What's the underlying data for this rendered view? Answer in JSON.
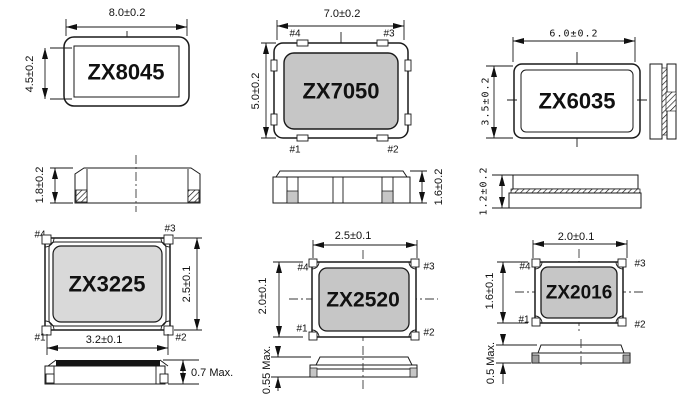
{
  "colors": {
    "line": "#1a1a1a",
    "body_gray": "#c6c6c6",
    "body_light_gray": "#d9d9d9",
    "lid_black": "#141414",
    "pad_gray": "#9e9e9e"
  },
  "packages": [
    {
      "name": "ZX8045",
      "length": "8.0±0.2",
      "width": "4.5±0.2",
      "height": "1.8±0.2"
    },
    {
      "name": "ZX7050",
      "length": "7.0±0.2",
      "width": "5.0±0.2",
      "height": "1.6±0.2",
      "pads": {
        "p1": "#1",
        "p2": "#2",
        "p3": "#3",
        "p4": "#4"
      }
    },
    {
      "name": "ZX6035",
      "length": "6.0±0.2",
      "width": "3.5±0.2",
      "height": "1.2±0.2"
    },
    {
      "name": "ZX3225",
      "length": "3.2±0.1",
      "width": "2.5±0.1",
      "height": "0.7 Max.",
      "pads": {
        "p1": "#1",
        "p2": "#2",
        "p3": "#3",
        "p4": "#4"
      }
    },
    {
      "name": "ZX2520",
      "length": "2.5±0.1",
      "width": "2.0±0.1",
      "height": "0.55 Max.",
      "pads": {
        "p1": "#1",
        "p2": "#2",
        "p3": "#3",
        "p4": "#4"
      }
    },
    {
      "name": "ZX2016",
      "length": "2.0±0.1",
      "width": "1.6±0.1",
      "height": "0.5 Max.",
      "pads": {
        "p1": "#1",
        "p2": "#2",
        "p3": "#3",
        "p4": "#4"
      }
    }
  ]
}
